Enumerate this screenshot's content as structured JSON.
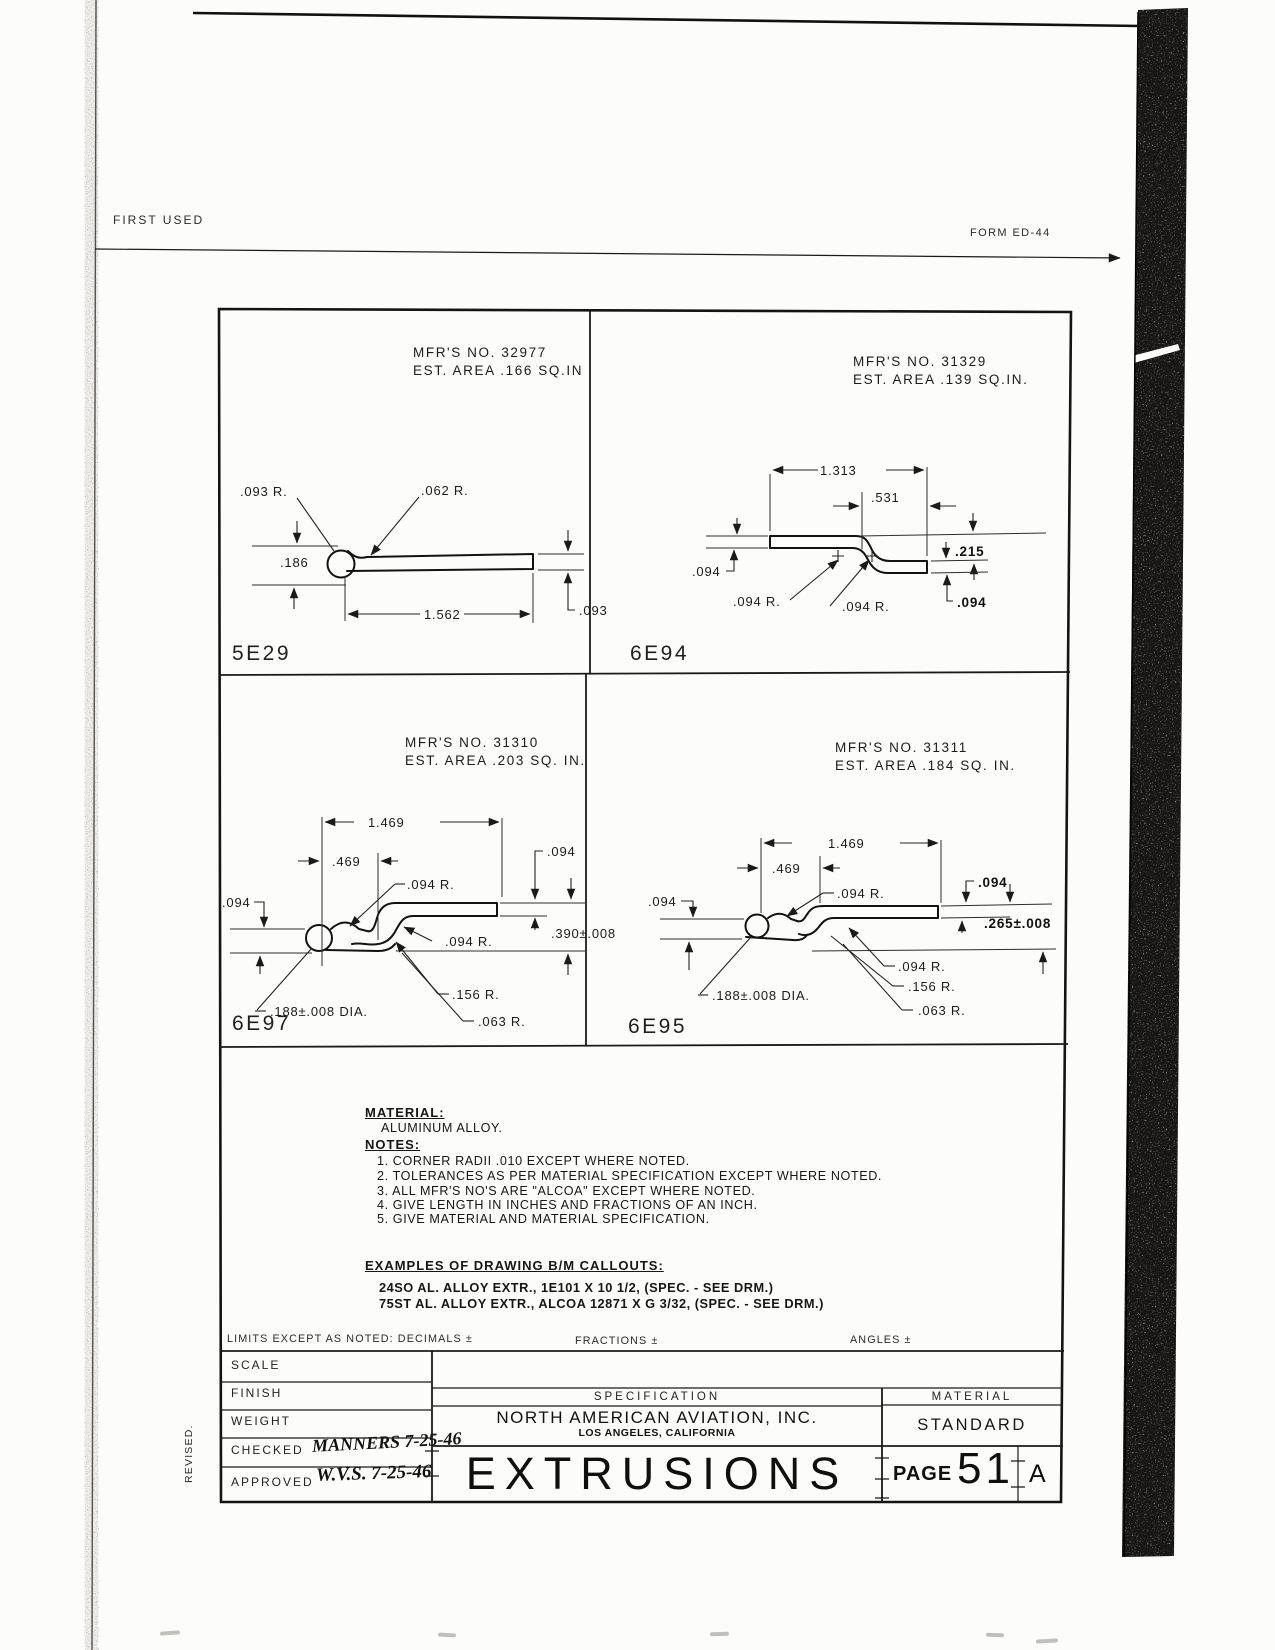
{
  "page": {
    "first_used": "FIRST USED",
    "form_no": "FORM ED-44",
    "revised": "REVISED."
  },
  "colors": {
    "ink": "#1b1b1b",
    "paper": "#fcfcfa",
    "scan_band": "#181614"
  },
  "parts": [
    {
      "id": "5E29",
      "mfr": "MFR'S NO. 32977",
      "area": "EST. AREA .166 SQ.IN",
      "dims": {
        "r1": ".093 R.",
        "r2": ".062 R.",
        "h": ".186",
        "w": "1.562",
        "t": ".093"
      }
    },
    {
      "id": "6E94",
      "mfr": "MFR'S NO. 31329",
      "area": "EST. AREA .139 SQ.IN.",
      "dims": {
        "w": "1.313",
        "w2": ".531",
        "tl": ".094",
        "off": ".215",
        "r1": ".094 R.",
        "r2": ".094 R.",
        "tr": ".094"
      }
    },
    {
      "id": "6E97",
      "mfr": "MFR'S NO. 31310",
      "area": "EST. AREA .203 SQ. IN.",
      "dims": {
        "w": "1.469",
        "w2": ".469",
        "r1": ".094 R.",
        "tt": ".094",
        "tl": ".094",
        "h": ".390±.008",
        "r2": ".094 R.",
        "r3": ".156 R.",
        "r4": ".063 R.",
        "dia": ".188±.008 DIA."
      }
    },
    {
      "id": "6E95",
      "mfr": "MFR'S NO. 31311",
      "area": "EST. AREA .184 SQ. IN.",
      "dims": {
        "w": "1.469",
        "w2": ".469",
        "r1": ".094 R.",
        "tl": ".094",
        "tt": ".094",
        "h": ".265±.008",
        "r2": ".094 R.",
        "r3": ".156 R.",
        "r4": ".063 R.",
        "dia": ".188±.008 DIA."
      }
    }
  ],
  "material_section": {
    "material_label": "MATERIAL:",
    "material_value": "ALUMINUM ALLOY.",
    "notes_label": "NOTES:",
    "notes": [
      "1. CORNER RADII .010 EXCEPT WHERE NOTED.",
      "2. TOLERANCES AS PER MATERIAL SPECIFICATION EXCEPT WHERE NOTED.",
      "3. ALL MFR'S NO'S ARE \"ALCOA\" EXCEPT WHERE NOTED.",
      "4. GIVE LENGTH IN INCHES AND FRACTIONS OF AN INCH.",
      "5. GIVE MATERIAL AND MATERIAL SPECIFICATION."
    ],
    "examples_label": "EXAMPLES OF DRAWING B/M CALLOUTS:",
    "examples": [
      "24SO AL. ALLOY EXTR., 1E101 X 10 1/2, (SPEC. - SEE DRM.)",
      "75ST AL. ALLOY EXTR., ALCOA 12871 X G 3/32, (SPEC. - SEE DRM.)"
    ]
  },
  "limits": {
    "limits_label": "LIMITS EXCEPT AS NOTED: DECIMALS ±",
    "fractions": "FRACTIONS ±",
    "angles": "ANGLES ±"
  },
  "title_block": {
    "scale": "SCALE",
    "finish": "FINISH",
    "weight": "WEIGHT",
    "checked": "CHECKED",
    "checked_value": "MANNERS 7-25-46",
    "approved": "APPROVED",
    "approved_value": "W.V.S. 7-25-46",
    "specification": "SPECIFICATION",
    "company": "NORTH AMERICAN AVIATION, INC.",
    "city": "LOS ANGELES, CALIFORNIA",
    "title": "EXTRUSIONS",
    "material_header": "MATERIAL",
    "material_value": "STANDARD",
    "page_label": "PAGE",
    "page_number": "51",
    "page_suffix": "A"
  }
}
